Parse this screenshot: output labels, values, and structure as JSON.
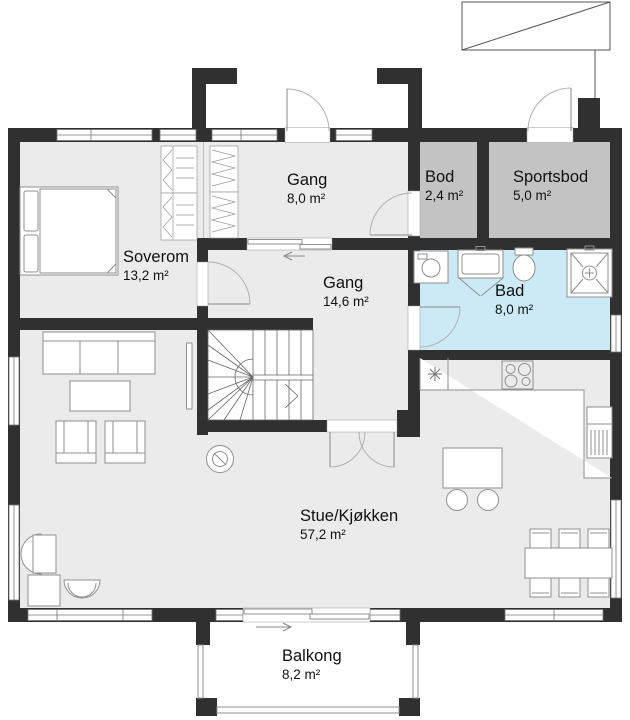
{
  "plan": {
    "type": "architectural-floor-plan",
    "rooms": {
      "soverom": {
        "name": "Soverom",
        "area": "13,2 m²"
      },
      "gang_entre": {
        "name": "Gang",
        "area": "8,0 m²"
      },
      "bod": {
        "name": "Bod",
        "area": "2,4 m²"
      },
      "sportsbod": {
        "name": "Sportsbod",
        "area": "5,0 m²"
      },
      "gang_midt": {
        "name": "Gang",
        "area": "14,6 m²"
      },
      "bad": {
        "name": "Bad",
        "area": "8,0 m²"
      },
      "stue_kjokken": {
        "name": "Stue/Kjøkken",
        "area": "57,2 m²"
      },
      "balkong": {
        "name": "Balkong",
        "area": "8,2 m²"
      }
    },
    "colors": {
      "wall": "#303030",
      "floor": "#ebebeb",
      "storage": "#c3c3c3",
      "bathroom": "#cbeaf6",
      "furniture_line": "#8f8f8f",
      "door_arc": "#b0b0b0",
      "text": "#111111"
    },
    "icons": [
      "double-bed-icon",
      "wardrobe-icon",
      "closet-zigzag-icon",
      "winder-stair-icon",
      "washing-machine-icon",
      "sink-vanity-icon",
      "toilet-icon",
      "shower-icon",
      "freezer-asterisk-icon",
      "cooktop-icon",
      "fridge-icon",
      "kitchen-island-icon",
      "bar-stool-icon",
      "sofa-icon",
      "coffee-table-icon",
      "armchair-icon",
      "tv-icon",
      "wood-stove-icon",
      "corner-desk-icon",
      "tub-chair-icon",
      "dining-table-icon",
      "dining-chair-icon",
      "external-stair-icon",
      "door-swing-icon",
      "sliding-door-icon",
      "window-icon",
      "direction-arrow-icon"
    ]
  }
}
